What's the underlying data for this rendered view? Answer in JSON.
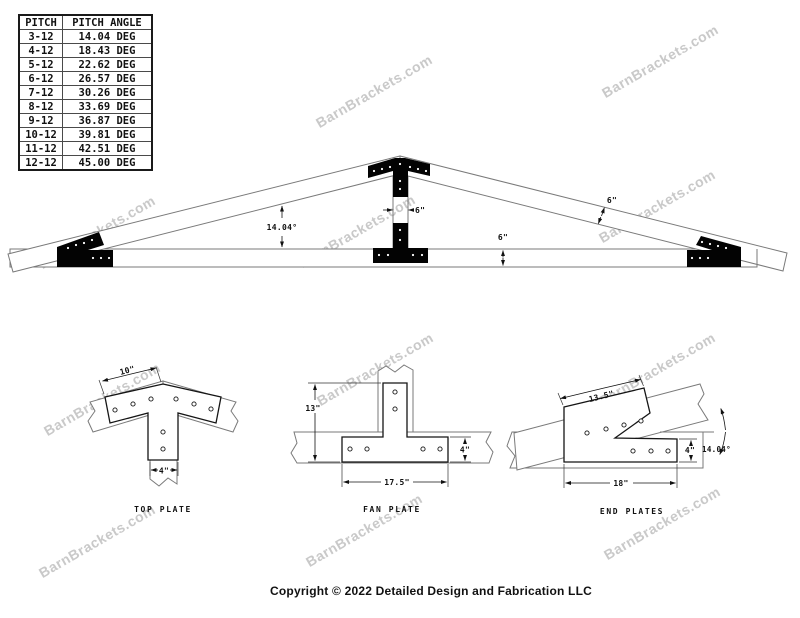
{
  "watermark": {
    "text": "BarnBrackets.com",
    "color": "#c9c9c9"
  },
  "pitch_table": {
    "headers": [
      "PITCH",
      "PITCH ANGLE"
    ],
    "rows": [
      {
        "pitch": "3-12",
        "angle": "14.04 DEG"
      },
      {
        "pitch": "4-12",
        "angle": "18.43 DEG"
      },
      {
        "pitch": "5-12",
        "angle": "22.62 DEG"
      },
      {
        "pitch": "6-12",
        "angle": "26.57 DEG"
      },
      {
        "pitch": "7-12",
        "angle": "30.26 DEG"
      },
      {
        "pitch": "8-12",
        "angle": "33.69 DEG"
      },
      {
        "pitch": "9-12",
        "angle": "36.87 DEG"
      },
      {
        "pitch": "10-12",
        "angle": "39.81 DEG"
      },
      {
        "pitch": "11-12",
        "angle": "42.51 DEG"
      },
      {
        "pitch": "12-12",
        "angle": "45.00 DEG"
      }
    ]
  },
  "truss": {
    "angle_label": "14.04°",
    "kingpost_width": "6\"",
    "chord_depth": "6\"",
    "rafter_depth": "6\""
  },
  "details": {
    "top_plate": {
      "label": "TOP PLATE",
      "arm_length": "10\"",
      "leg_width": "4\""
    },
    "fan_plate": {
      "label": "FAN PLATE",
      "height": "13\"",
      "base_width": "17.5\"",
      "base_height": "4\""
    },
    "end_plates": {
      "label": "END PLATES",
      "slope_length": "13.5\"",
      "base_width": "18\"",
      "base_height": "4\"",
      "angle": "14.04°"
    }
  },
  "footer": {
    "copyright": "Copyright © 2022 Detailed Design and Fabrication LLC"
  },
  "colors": {
    "bracket": "#030303",
    "beam_line": "#7a7a7a",
    "dim_text": "#111111",
    "watermark": "#c9c9c9"
  }
}
